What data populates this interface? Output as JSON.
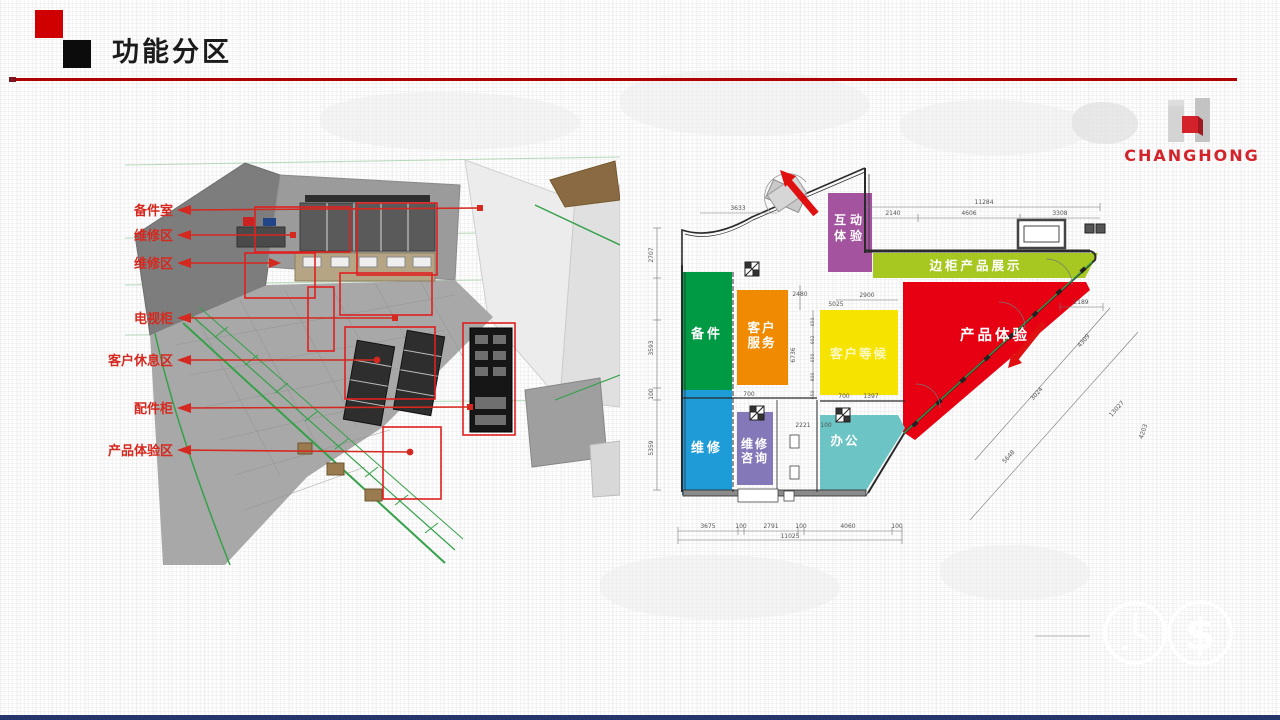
{
  "slide": {
    "title": "功能分区"
  },
  "brand": {
    "name": "CHANGHONG"
  },
  "render": {
    "labels": [
      {
        "text": "备件室"
      },
      {
        "text": "维修区"
      },
      {
        "text": "维修区"
      },
      {
        "text": "电视柜"
      },
      {
        "text": "客户休息区"
      },
      {
        "text": "配件柜"
      },
      {
        "text": "产品体验区"
      }
    ]
  },
  "floorplan": {
    "zones": [
      {
        "name": "互动体验",
        "lines": [
          "互动",
          "体验"
        ],
        "color": "#a4539f"
      },
      {
        "name": "边柜产品展示",
        "color": "#a6c820"
      },
      {
        "name": "备件",
        "color": "#019a44"
      },
      {
        "name": "客户服务",
        "lines": [
          "客户",
          "服务"
        ],
        "color": "#f08a00"
      },
      {
        "name": "客户等候",
        "color": "#f6e400"
      },
      {
        "name": "产品体验",
        "color": "#e60012"
      },
      {
        "name": "维修",
        "color": "#1e9cd7"
      },
      {
        "name": "维修咨询",
        "lines": [
          "维修",
          "咨询"
        ],
        "color": "#8478b8"
      },
      {
        "name": "办公",
        "color": "#6cc4c4"
      }
    ],
    "dims": {
      "top_total": "11284",
      "top": [
        "2140",
        "4606",
        "3308"
      ],
      "right": "2189",
      "diagonal": [
        "4309",
        "3024",
        "13027",
        "5648",
        "4203"
      ],
      "bottom": [
        "3675",
        "100",
        "2791",
        "100",
        "4060",
        "100"
      ],
      "bottom_total": "11025",
      "left": [
        "2707",
        "3593",
        "100",
        "5359"
      ],
      "inner": [
        "3633",
        "2480",
        "5025",
        "2900",
        "6736",
        "700",
        "700",
        "1397",
        "2221",
        "100",
        "650",
        "602",
        "650",
        "800",
        "650"
      ]
    }
  },
  "footer": {
    "currency_glyph": "$"
  }
}
